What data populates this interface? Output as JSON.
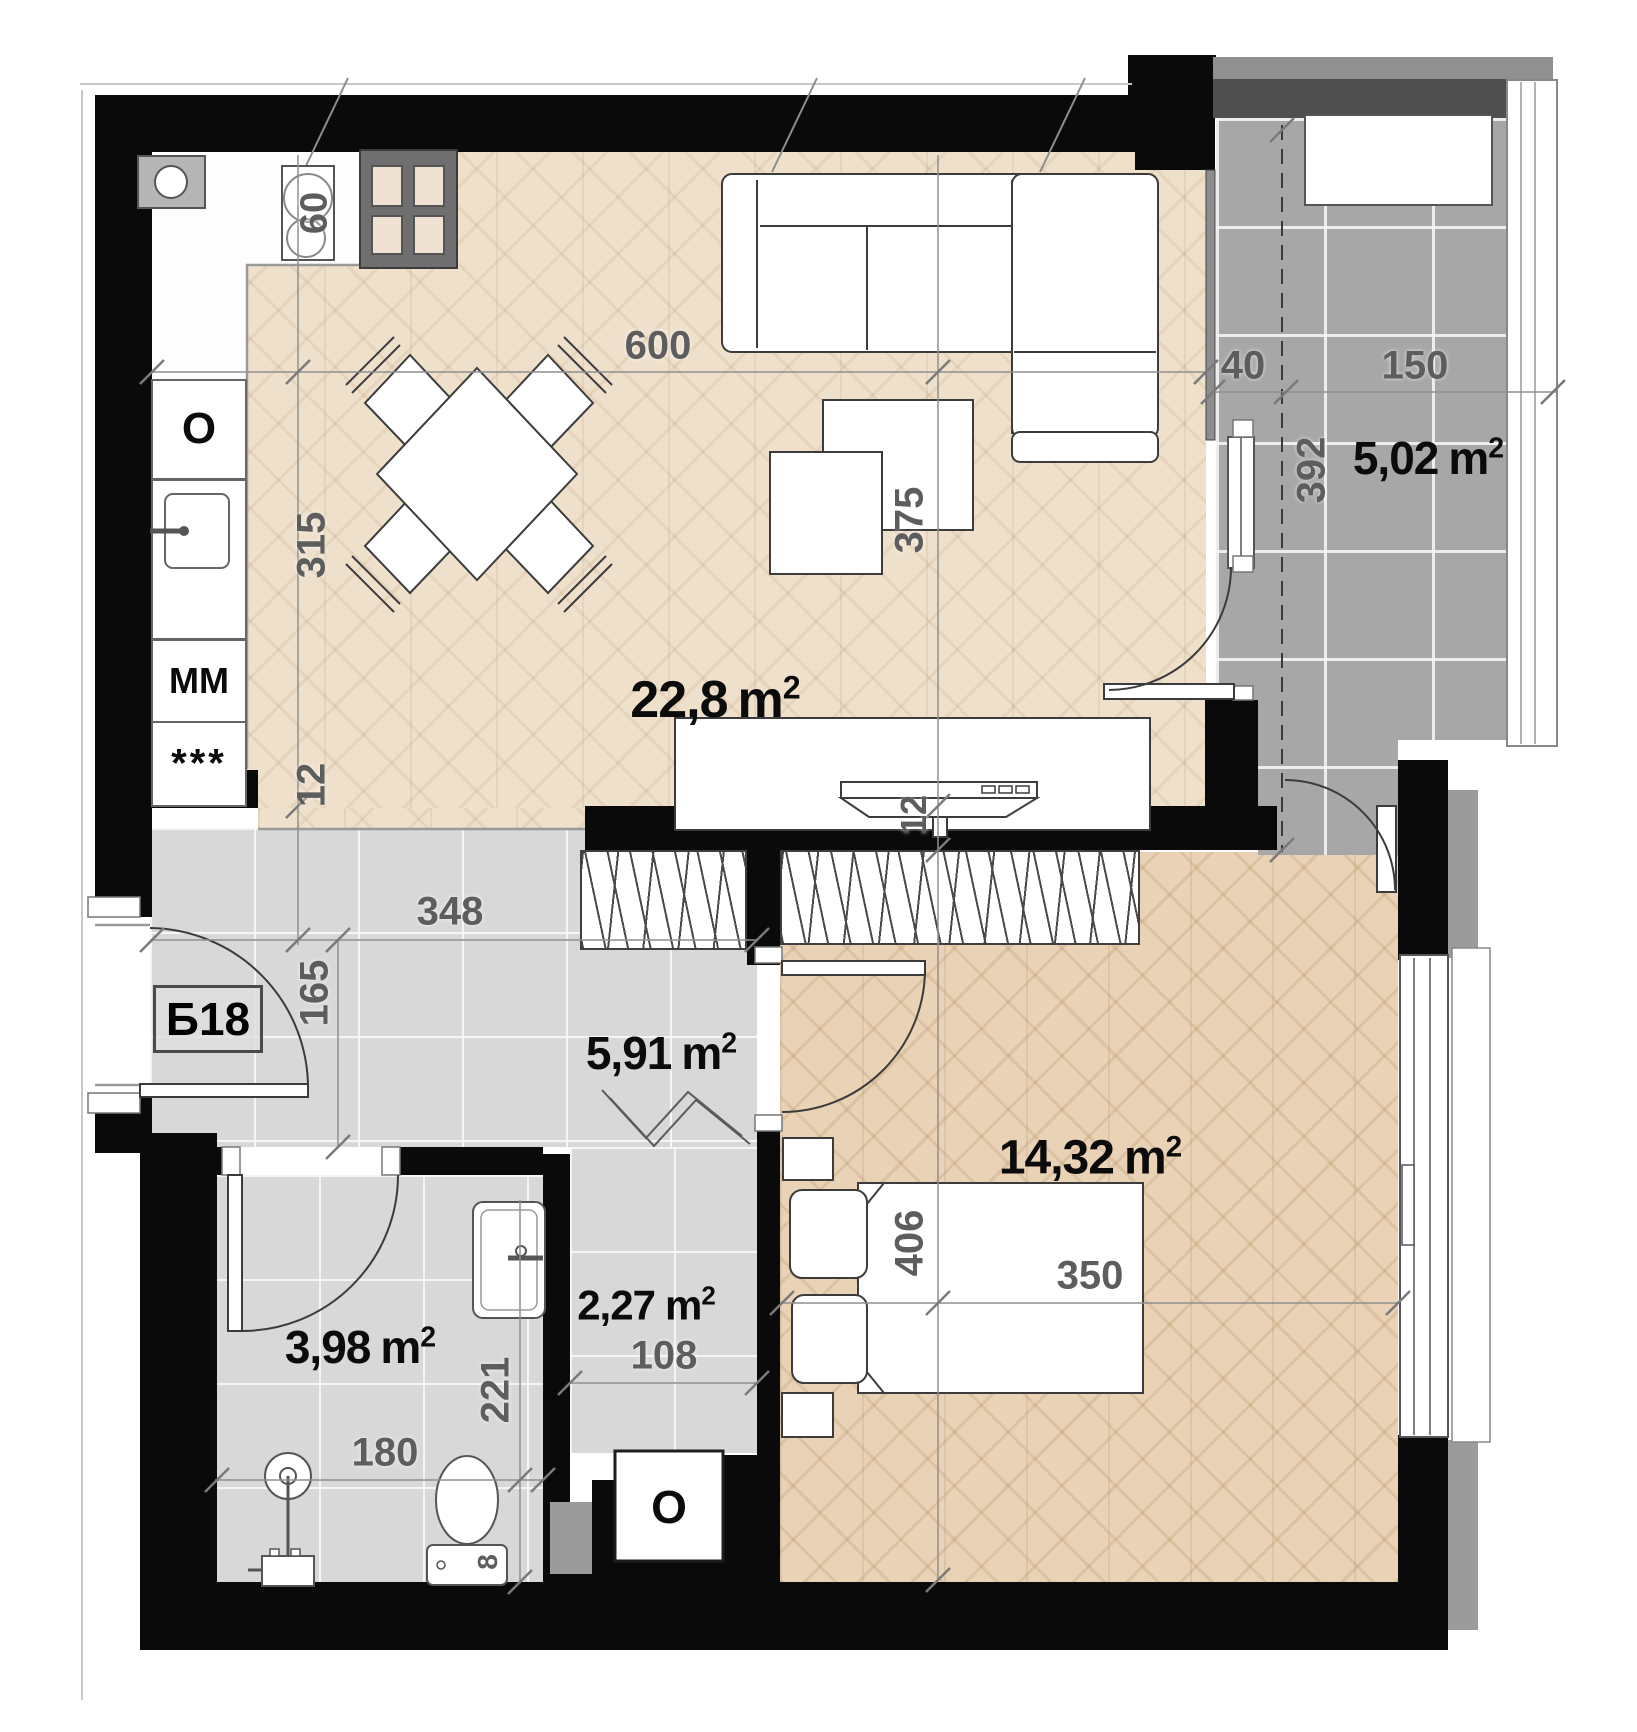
{
  "title": "Apartment floor plan",
  "unit": {
    "code": "Б18"
  },
  "units": {
    "m": "m",
    "sup": "2"
  },
  "rooms": {
    "living": {
      "name": "living-room-kitchen",
      "value": "22,8"
    },
    "balcony": {
      "name": "balcony",
      "value": "5,02"
    },
    "hall": {
      "name": "entrance-hall",
      "value": "5,91"
    },
    "bedroom": {
      "name": "bedroom",
      "value": "14,32"
    },
    "bath": {
      "name": "bathroom",
      "value": "3,98"
    },
    "corridor": {
      "name": "corridor",
      "value": "2,27"
    }
  },
  "dims": {
    "d600": "600",
    "d375": "375",
    "d315": "315",
    "d12k": "12",
    "d12t": "12",
    "d60": "60",
    "d40": "40",
    "d150": "150",
    "d392": "392",
    "d348": "348",
    "d165": "165",
    "d406": "406",
    "d350": "350",
    "d221": "221",
    "d180": "180",
    "d108": "108",
    "d8": "8"
  },
  "appliances": {
    "oven": "O",
    "washer": "MM",
    "freezer": "***",
    "duct": "O"
  },
  "colors": {
    "wall": "#0a0a0a",
    "parquet_living": "#efe0cc",
    "parquet_bedroom": "#e9d2b6",
    "tile_gray": "#d8d8d8",
    "balcony_tile": "#a7a7a7",
    "dim_text": "#5d5d5d",
    "area_text": "#0b0b0b"
  }
}
